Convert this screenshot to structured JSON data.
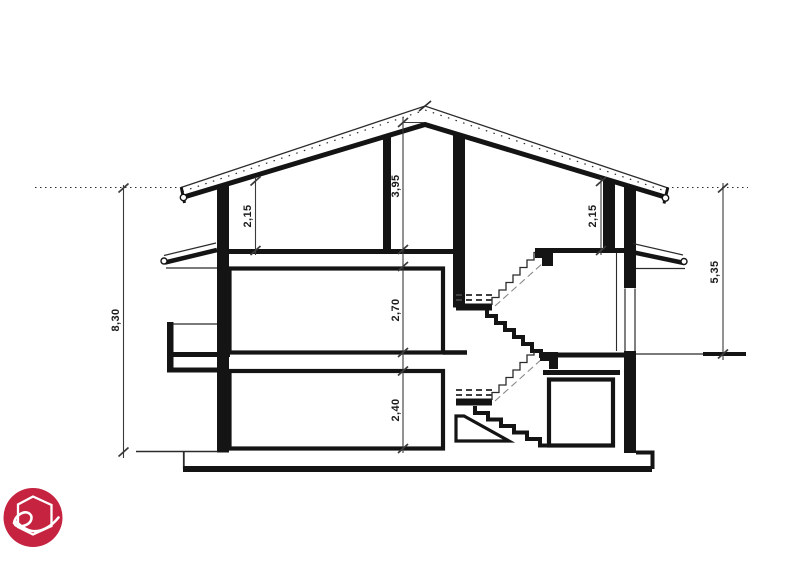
{
  "document": {
    "type": "architectural-cross-section",
    "background_color": "#ffffff",
    "line_color": "#141414"
  },
  "dimensions": {
    "attic_left_height": "2,15",
    "ridge_height": "3,95",
    "attic_right_height": "2,15",
    "first_floor_height": "2,70",
    "ground_floor_height": "2,40",
    "total_height_left": "8,30",
    "height_right": "5,35"
  },
  "logo": {
    "background_color": "#c52340",
    "glyph": "e",
    "shape": "house-outline"
  }
}
